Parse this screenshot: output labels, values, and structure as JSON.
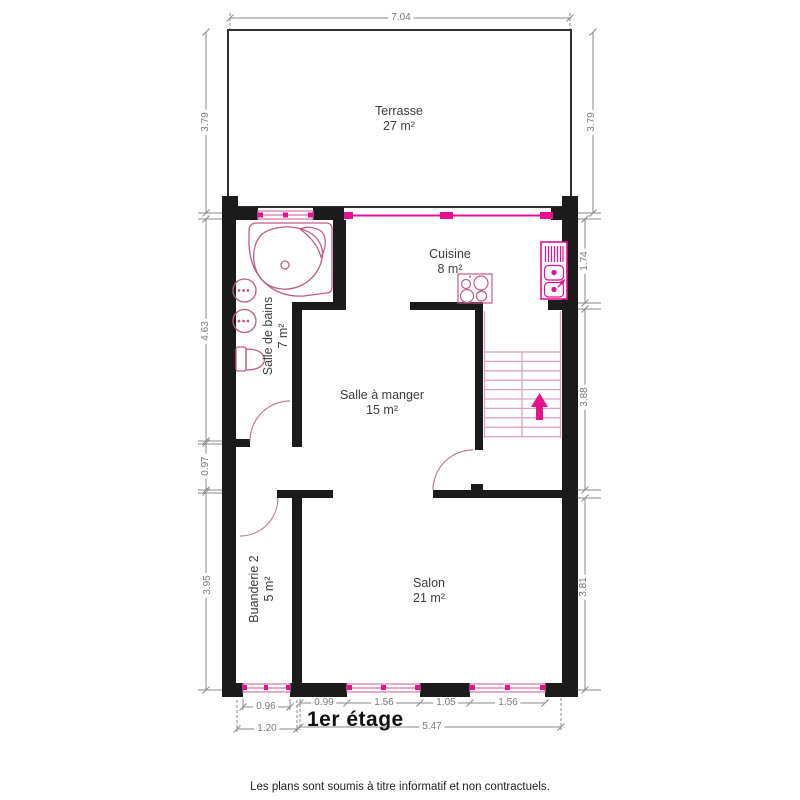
{
  "page": {
    "floor_label": "1er étage",
    "disclaimer": "Les plans sont soumis à titre informatif et non contractuels."
  },
  "rooms": {
    "terrasse": {
      "name": "Terrasse",
      "area": "27 m²"
    },
    "cuisine": {
      "name": "Cuisine",
      "area": "8 m²"
    },
    "salle_de_bains": {
      "name": "Salle de bains",
      "area": "7 m²"
    },
    "salle_a_manger": {
      "name": "Salle à manger",
      "area": "15 m²"
    },
    "buanderie": {
      "name": "Buanderie 2",
      "area": "5 m²"
    },
    "salon": {
      "name": "Salon",
      "area": "21 m²"
    }
  },
  "dimensions": {
    "terrace_width": "7.04",
    "terrace_depth_left": "3.79",
    "terrace_depth_right": "3.79",
    "cuisine_right": "1.74",
    "stair_right": "3.88",
    "salon_right": "3.81",
    "bains_left": "4.63",
    "hall_left": "0.97",
    "buanderie_left": "3.95",
    "buanderie_window": "0.96",
    "buanderie_width": "1.20",
    "salon_seg1": "0.99",
    "salon_seg2": "1.56",
    "salon_seg3": "1.05",
    "salon_seg4": "1.56",
    "salon_width": "5.47"
  },
  "colors": {
    "wall": "#1b1b1b",
    "fixture_pink": "#c05c8c",
    "accent_magenta": "#e61090",
    "stair_tread": "#dca2c4",
    "door_arc": "#b9848e",
    "dimension_gray": "#8a8a8a"
  }
}
